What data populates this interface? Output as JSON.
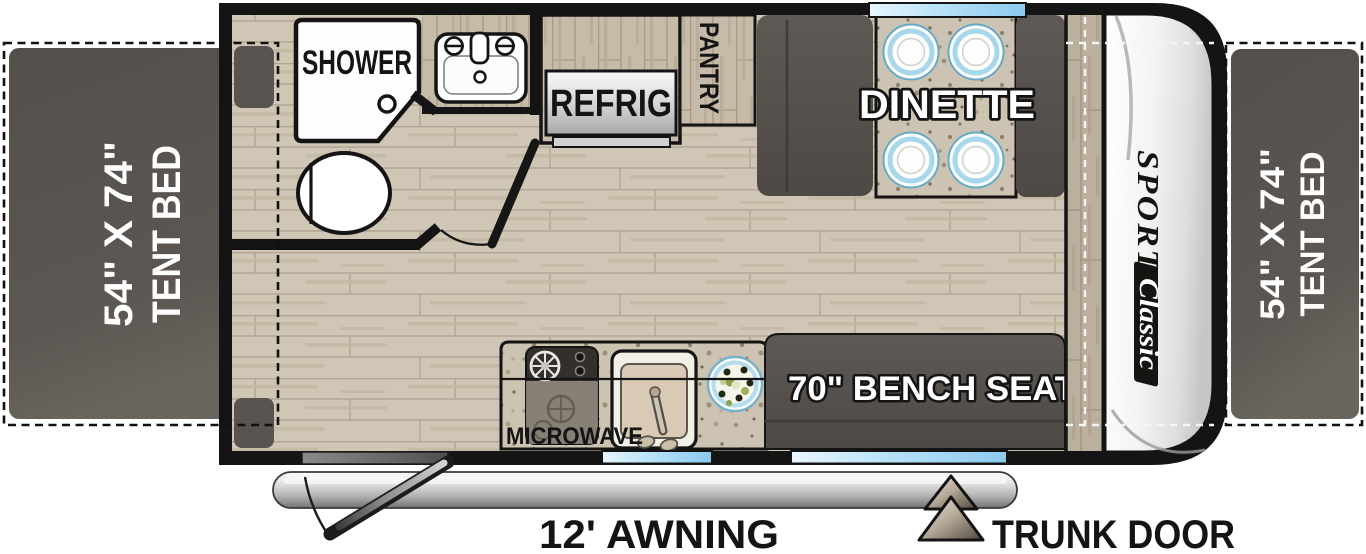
{
  "floorplan": {
    "beds": {
      "left": {
        "size": "54\" X 74\"",
        "label": "TENT BED"
      },
      "right": {
        "size": "54\" X 74\"",
        "label": "TENT BED"
      }
    },
    "bathroom": {
      "shower_label": "SHOWER"
    },
    "kitchen": {
      "refrigerator_label": "REFRIG",
      "pantry_label": "PANTRY",
      "microwave_label": "MICROWAVE"
    },
    "dinette": {
      "label": "DINETTE"
    },
    "bench_seat": {
      "label": "70\" BENCH SEAT"
    },
    "exterior": {
      "awning_label": "12' AWNING",
      "trunk_door_label": "TRUNK DOOR"
    },
    "brand": {
      "name": "SPORTSMEN",
      "series": "Classic"
    },
    "colors": {
      "wall": "#141414",
      "floor_wood": "#cfc6b5",
      "cabinet_wood": "#c6baa8",
      "window_blue": "#8cc9ee",
      "bed_dark": "#59544f",
      "bench_dark": "#57524d",
      "granite": "#ccc3b2",
      "front_cap": "#f2f2f2",
      "awning_gray": "#c9c9c9"
    }
  }
}
